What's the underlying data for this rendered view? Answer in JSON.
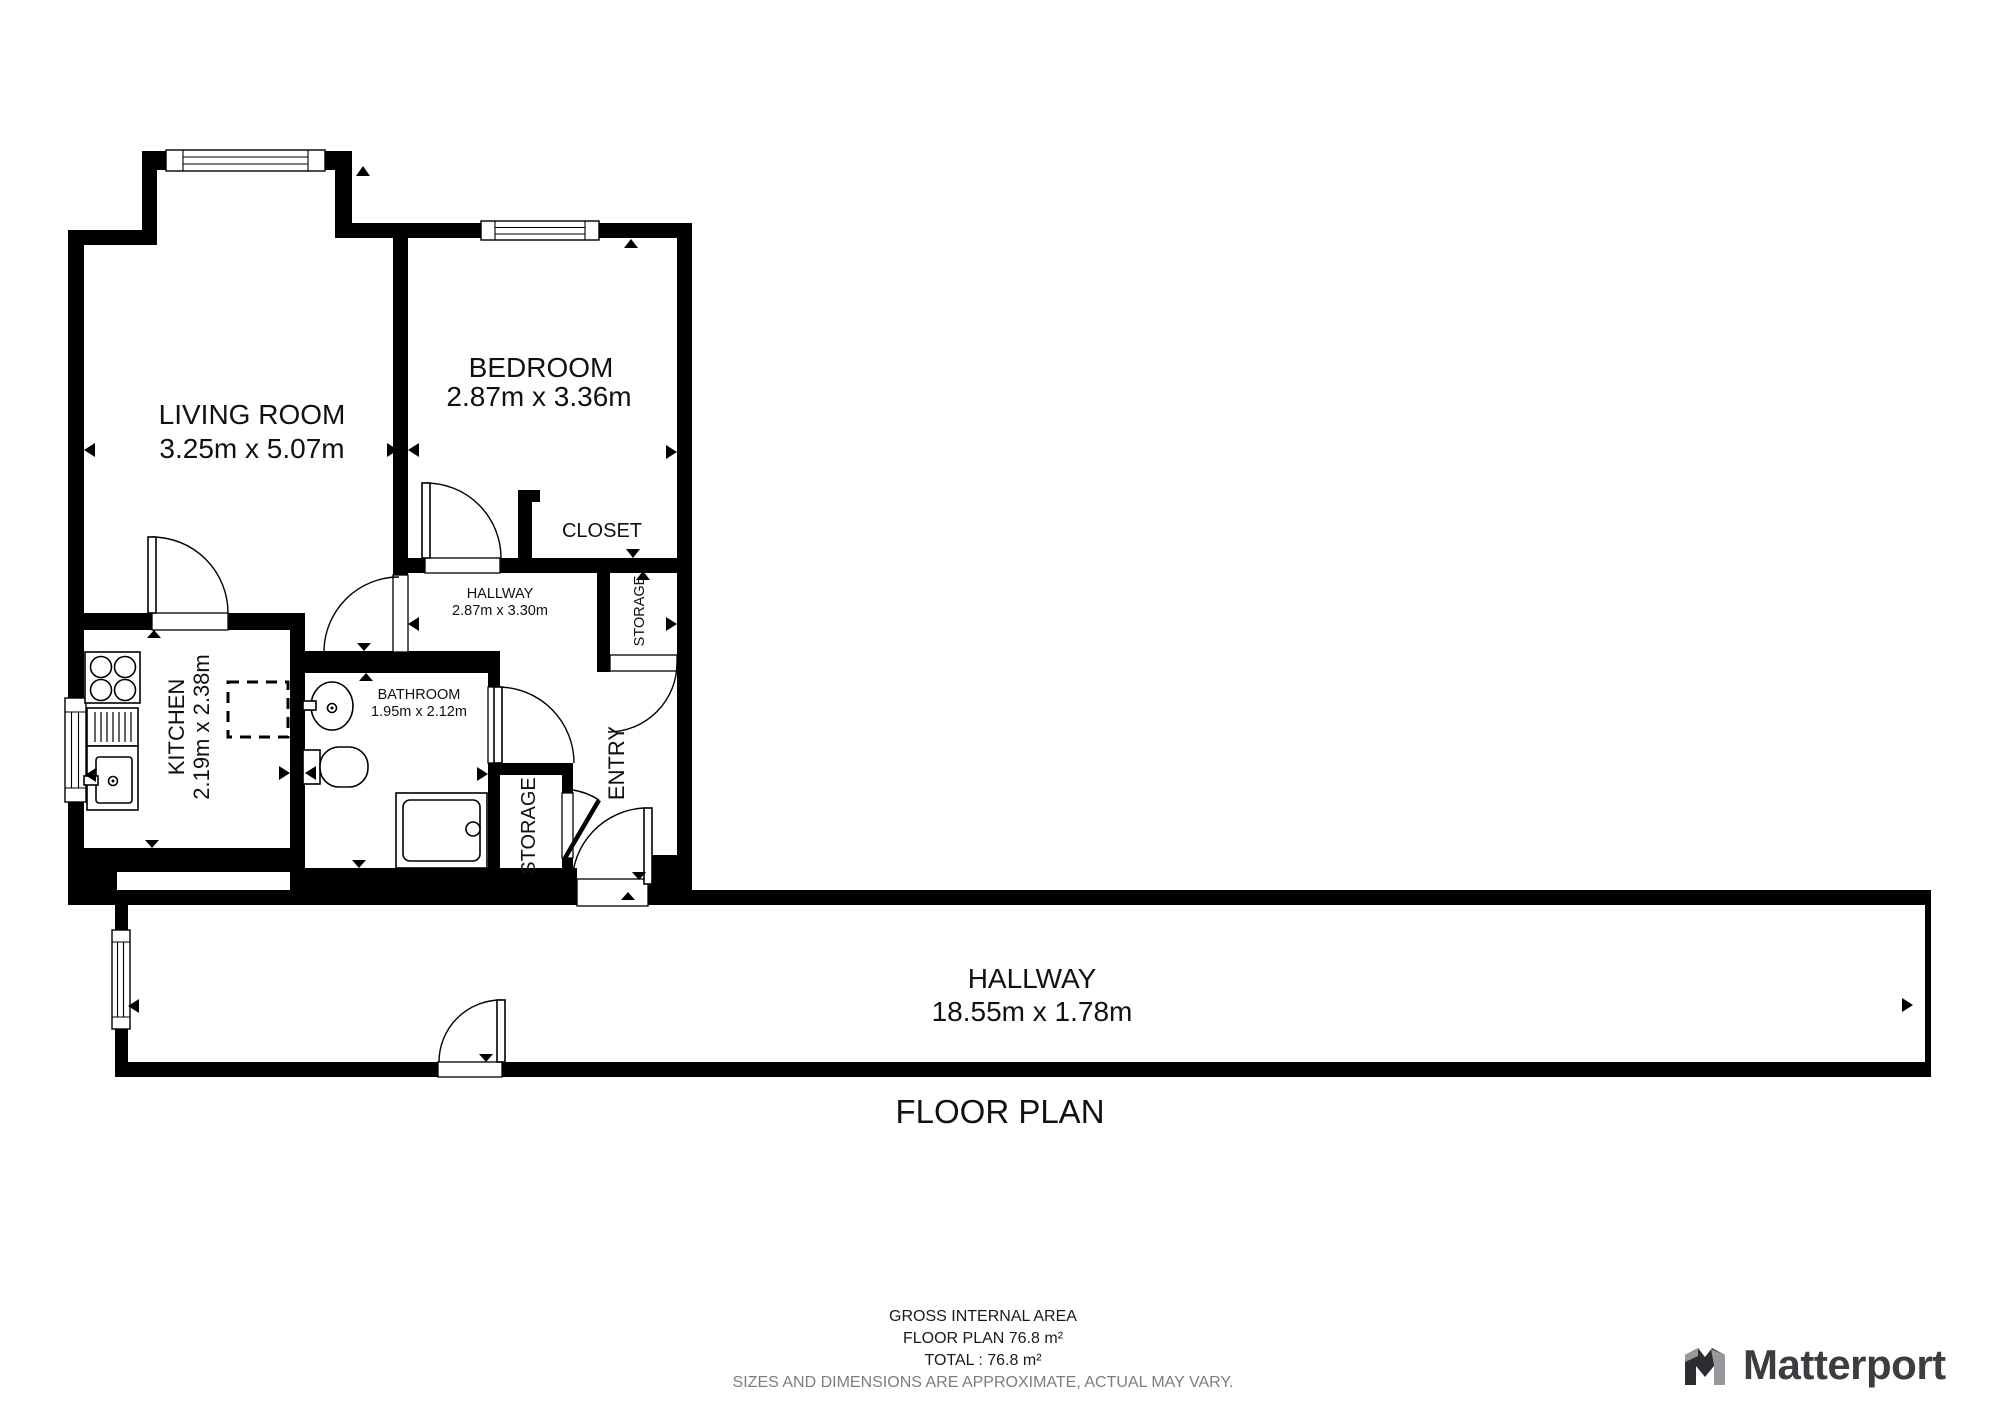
{
  "title": "FLOOR PLAN",
  "rooms": {
    "living_room": {
      "name": "LIVING ROOM",
      "dims": "3.25m x 5.07m"
    },
    "bedroom": {
      "name": "BEDROOM",
      "dims": "2.87m x 3.36m"
    },
    "closet": {
      "name": "CLOSET"
    },
    "hallway_small": {
      "name": "HALLWAY",
      "dims": "2.87m x 3.30m"
    },
    "kitchen": {
      "name": "KITCHEN",
      "dims": "2.19m x 2.38m"
    },
    "bathroom": {
      "name": "BATHROOM",
      "dims": "1.95m x 2.12m"
    },
    "entry": {
      "name": "ENTRY"
    },
    "storage_upper": {
      "name": "STORAGE"
    },
    "storage_lower": {
      "name": "STORAGE"
    },
    "hallway_long": {
      "name": "HALLWAY",
      "dims": "18.55m x 1.78m"
    }
  },
  "footer": {
    "line1": "GROSS INTERNAL AREA",
    "line2": "FLOOR PLAN 76.8 m²",
    "line3": "TOTAL :  76.8 m²",
    "disclaimer": "SIZES AND DIMENSIONS ARE APPROXIMATE, ACTUAL MAY VARY."
  },
  "branding": {
    "logo_text": "Matterport"
  },
  "colors": {
    "wall": "#000000",
    "background": "#ffffff",
    "disclaimer_gray": "#7d7d7d",
    "logo_dark": "#3c3d41",
    "logo_gray": "#97989b"
  }
}
